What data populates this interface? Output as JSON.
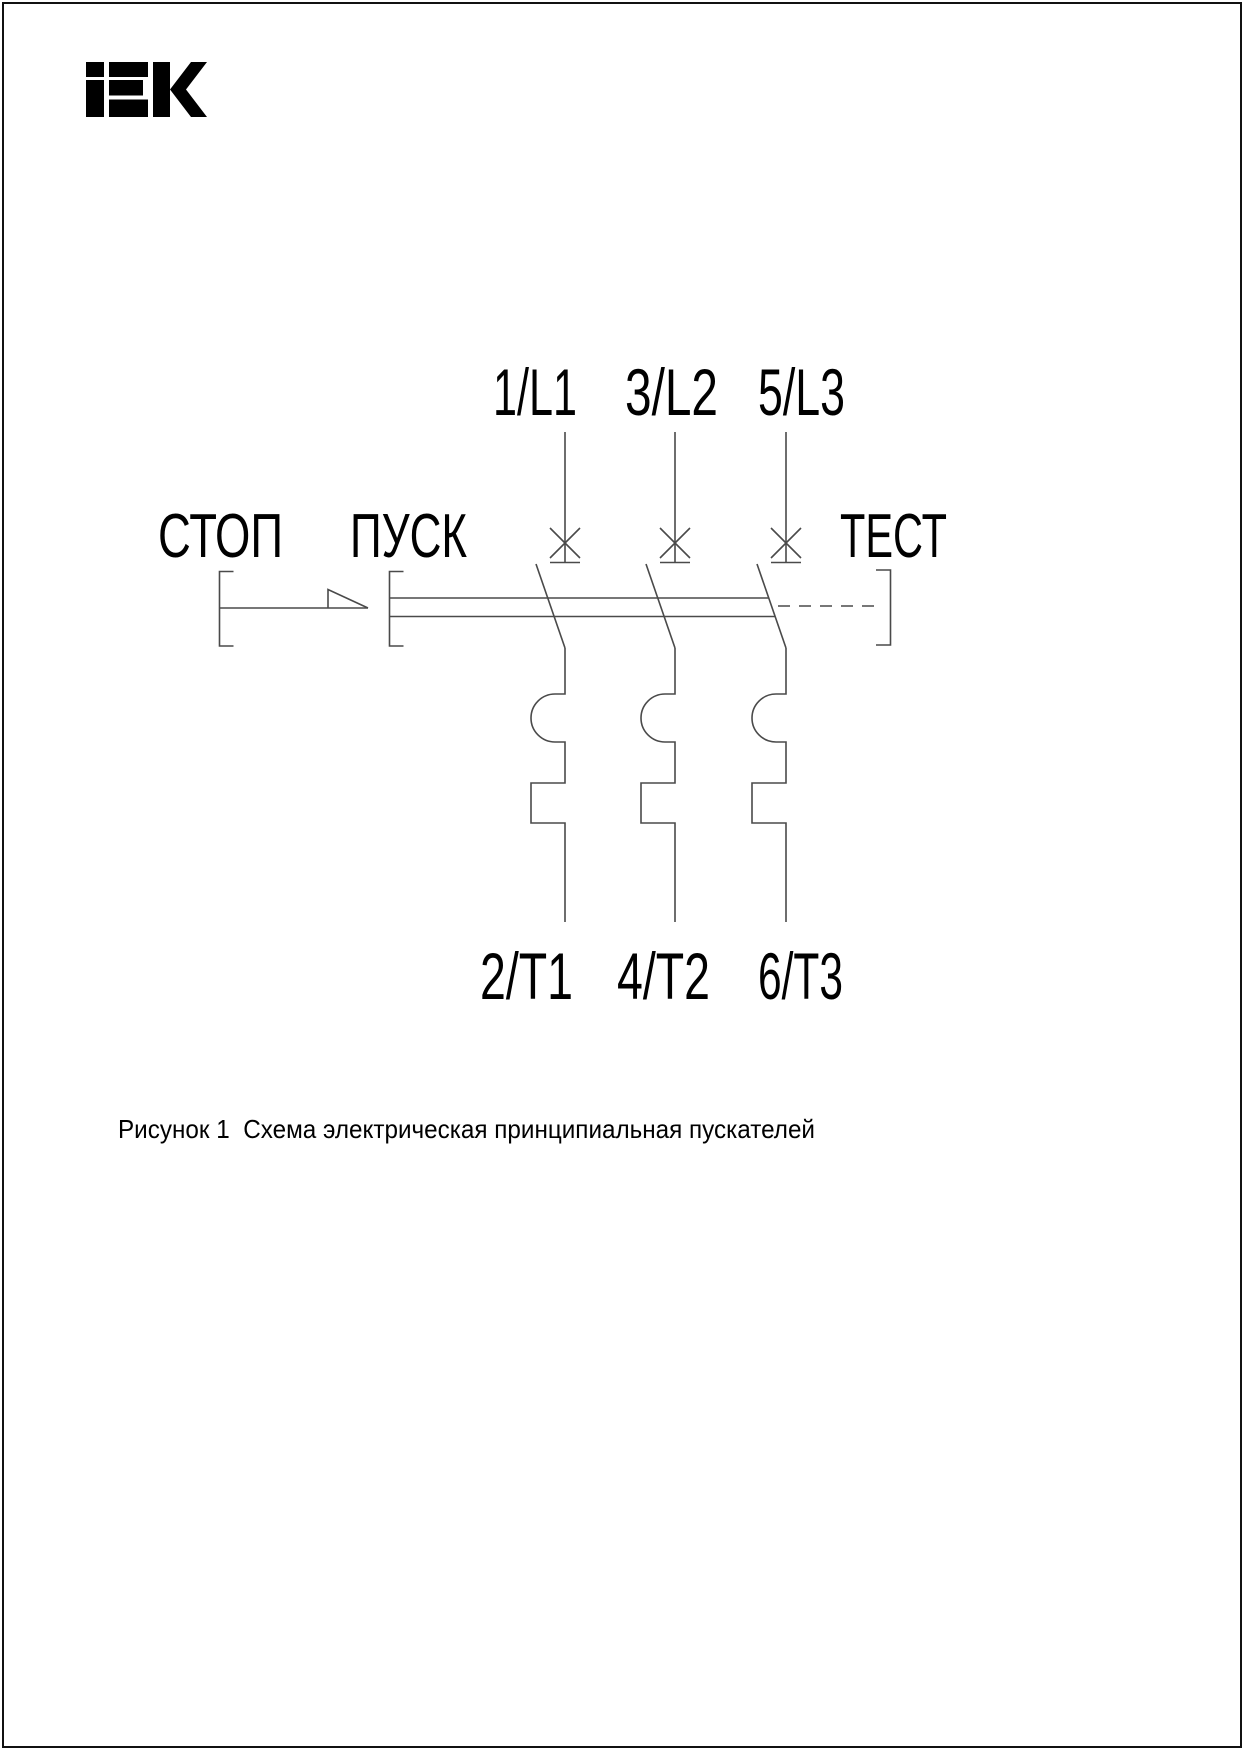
{
  "colors": {
    "background": "#ffffff",
    "border": "#111111",
    "line": "#4a4a4a",
    "text": "#000000"
  },
  "page": {
    "brand": "IEK"
  },
  "schematic": {
    "stop_label": "СТОП",
    "start_label": "ПУСК",
    "test_label": "ТЕСТ",
    "poles": [
      {
        "top_terminal": "1/L1",
        "bottom_terminal": "2/T1"
      },
      {
        "top_terminal": "3/L2",
        "bottom_terminal": "4/T2"
      },
      {
        "top_terminal": "5/L3",
        "bottom_terminal": "6/T3"
      }
    ],
    "caption": "Рисунок 1  Схема электрическая принципиальная пускателей"
  }
}
